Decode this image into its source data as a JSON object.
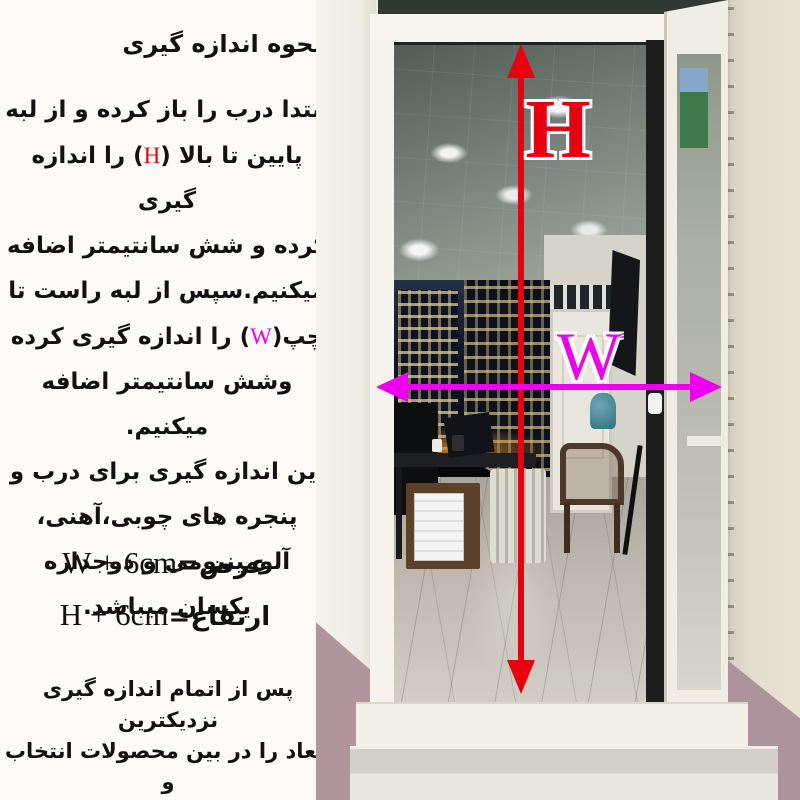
{
  "page": {
    "title": "نحوه اندازه گیری"
  },
  "instructions": {
    "line1": "ابتدا درب را باز کرده و از لبه",
    "line2_pre": "پایین تا بالا (",
    "line2_h": "H",
    "line2_post": ") را اندازه گیری",
    "line3": "کرده و شش سانتیمتر اضافه",
    "line4": "میکنیم.سپس از لبه راست تا",
    "line5_pre": "چپ(",
    "line5_w": "W",
    "line5_post": ") را اندازه گیری کرده",
    "line6": "وشش سانتیمتر اضافه میکنیم.",
    "line7": "این اندازه گیری برای درب و",
    "line8": "پنجره های چوبی،آهنی،",
    "line9": "آلومینیومی و دوجداره",
    "line10": "یکسان میباشد."
  },
  "formulas": {
    "width_label": "عرض",
    "width_eq": "=",
    "width_expr": "W + 6cm",
    "height_label": "ارتفاع",
    "height_eq": "=",
    "height_expr": "H + 6cm"
  },
  "footer": {
    "line1": "پس از اتمام اندازه گیری نزدیکترین",
    "line2": "ابعاد را در بین محصولات انتخاب و",
    "line3": "خریداری کنید."
  },
  "photo": {
    "height_marker": "H",
    "width_marker": "W"
  },
  "colors": {
    "height_red": "#e8000f",
    "width_magenta": "#ee00ee",
    "text_black": "#121212"
  }
}
